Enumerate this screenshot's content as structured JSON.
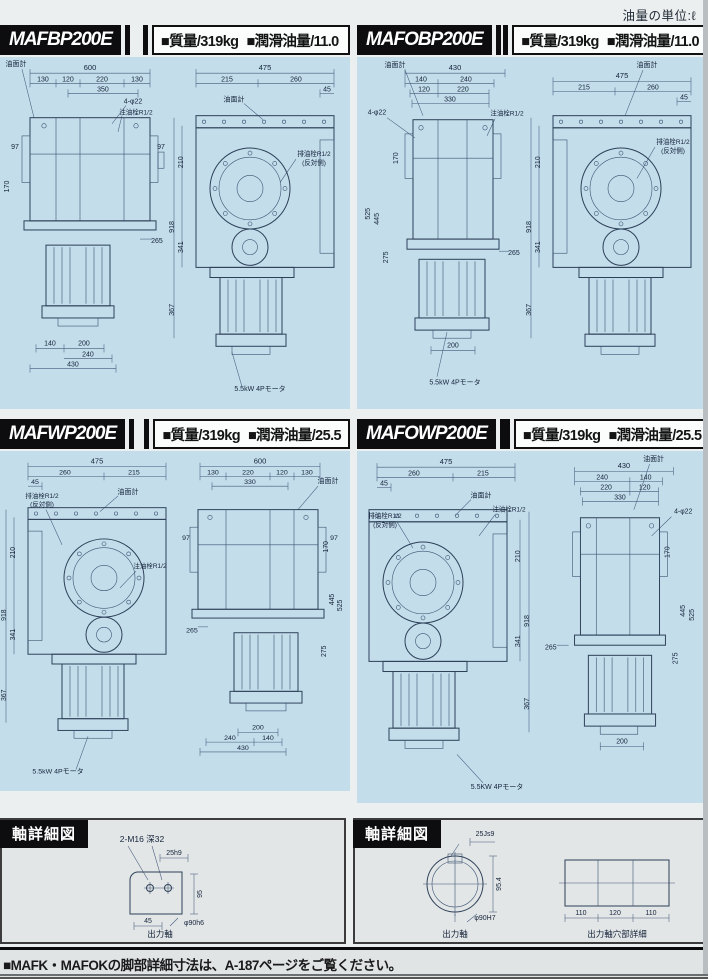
{
  "page": {
    "unit_note": "油量の単位:ℓ",
    "footer_note": "■MAFK・MAFOKの脚部詳細寸法は、A-187ページをご覧ください。"
  },
  "panels": [
    {
      "model": "MAFBP200E",
      "mass": "■質量/319kg",
      "oil": "■潤滑油量/11.0",
      "side": {
        "gauge": "油面計",
        "total": "600",
        "seg1": "130",
        "seg2": "120",
        "seg3": "220",
        "seg4": "130",
        "inner": "350",
        "holes": "4-φ22",
        "plug": "注油栓R1/2",
        "s_left": "97",
        "s_right": "97",
        "v170": "170",
        "r265": "265",
        "b140": "140",
        "b200": "200",
        "b240": "240",
        "b430": "430"
      },
      "front": {
        "total": "475",
        "seg1": "215",
        "seg2": "260",
        "seg3": "45",
        "gauge": "油面計",
        "drain": "排油栓R1/2",
        "drain_side": "(反対側)",
        "v210": "210",
        "v341": "341",
        "v918": "918",
        "v367": "367",
        "motor": "5.5kW 4Pモータ"
      }
    },
    {
      "model": "MAFOBP200E",
      "mass": "■質量/319kg",
      "oil": "■潤滑油量/11.0",
      "side": {
        "gauge": "油面計",
        "total": "430",
        "seg1": "140",
        "seg2": "240",
        "seg3": "120",
        "seg4": "220",
        "inner": "330",
        "holes": "4-φ22",
        "plug": "注油栓R1/2",
        "v170": "170",
        "v525": "525",
        "v445": "445",
        "v275": "275",
        "r265": "265",
        "b200": "200",
        "motor": "5.5kW 4Pモータ"
      },
      "front": {
        "total": "475",
        "seg1": "215",
        "seg2": "260",
        "seg3": "45",
        "gauge": "油面計",
        "drain": "排油栓R1/2",
        "drain_side": "(反対側)",
        "v210": "210",
        "v341": "341",
        "v918": "918",
        "v367": "367"
      }
    },
    {
      "model": "MAFWP200E",
      "mass": "■質量/319kg",
      "oil": "■潤滑油量/25.5",
      "front": {
        "total": "475",
        "seg1": "260",
        "seg2": "215",
        "seg3": "45",
        "gauge": "油面計",
        "drain": "排油栓R1/2",
        "drain_side": "(反対側)",
        "plug": "注油栓R1/2",
        "v210": "210",
        "v341": "341",
        "v918": "918",
        "v367": "367",
        "motor": "5.5kW 4Pモータ"
      },
      "side": {
        "gauge": "油面計",
        "total": "600",
        "seg1": "130",
        "seg2": "220",
        "seg3": "120",
        "seg4": "130",
        "inner": "330",
        "s_left": "97",
        "s_right": "97",
        "v170": "170",
        "v445": "445",
        "v525": "525",
        "v275": "275",
        "r265": "265",
        "b200": "200",
        "b140": "140",
        "b240": "240",
        "b430": "430"
      }
    },
    {
      "model": "MAFOWP200E",
      "mass": "■質量/319kg",
      "oil": "■潤滑油量/25.5",
      "front": {
        "total": "475",
        "seg1": "260",
        "seg2": "215",
        "seg3": "45",
        "gauge": "油面計",
        "plug": "注油栓R1/2",
        "drain": "排油栓R1/2",
        "drain_side": "(反対側)",
        "v210": "210",
        "v341": "341",
        "v918": "918",
        "v367": "367",
        "motor": "5.5KW 4Pモータ"
      },
      "side": {
        "gauge": "油面計",
        "total": "430",
        "seg1": "240",
        "seg2": "140",
        "seg3": "220",
        "seg4": "120",
        "inner": "330",
        "holes": "4-φ22",
        "v170": "170",
        "v445": "445",
        "v525": "525",
        "v275": "275",
        "r265": "265",
        "b200": "200"
      }
    }
  ],
  "shaft": [
    {
      "title": "軸詳細図",
      "tap": "2-M16 深32",
      "key": "25h9",
      "w45": "45",
      "dia": "φ90h6",
      "height": "95",
      "caption": "出力軸"
    },
    {
      "title": "軸詳細図",
      "key": "25Js9",
      "height": "95.4",
      "dia": "φ90H7",
      "caption": "出力軸",
      "h1": "110",
      "h2": "120",
      "h3": "110",
      "caption2": "出力軸穴部詳細"
    }
  ]
}
